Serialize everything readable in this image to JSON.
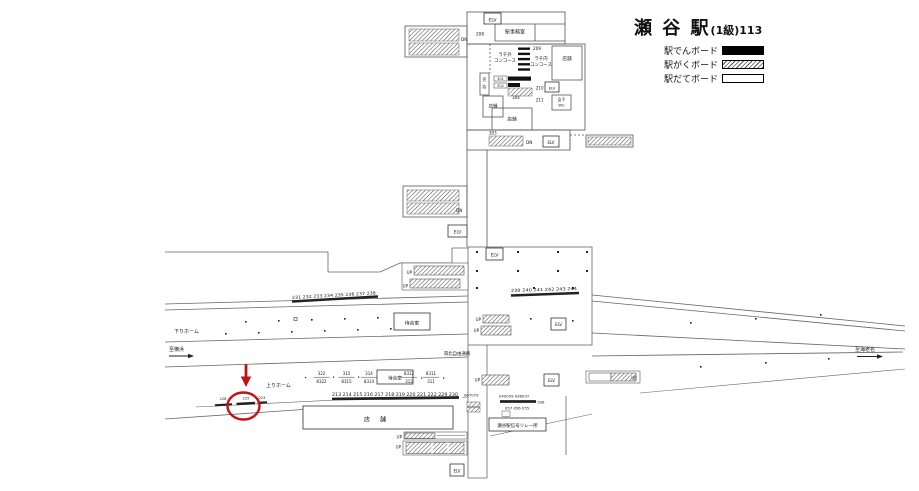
{
  "header": {
    "station_name": "瀬 谷 駅",
    "station_grade": "(1級)113"
  },
  "legend": {
    "items": [
      {
        "label": "駅でんボード",
        "style": "solid"
      },
      {
        "label": "駅がくボード",
        "style": "hatched"
      },
      {
        "label": "駅だてボード",
        "style": "outline"
      }
    ]
  },
  "labels": {
    "elv": "ELV",
    "up": "UP",
    "dn": "DN",
    "office": "駅事務室",
    "shop": "店舗",
    "shop_wide": "店 舗",
    "kiosk_1": "売",
    "kiosk_2": "店",
    "concourse_out_1": "ラチ外",
    "concourse_out_2": "コンコース",
    "concourse_in_1": "ラチ内",
    "concourse_in_2": "コンコース",
    "womens_1": "女子",
    "womens_2": "WC",
    "waiting_room": "待合室",
    "down_platform": "下りホーム",
    "up_platform": "上りホーム",
    "to_yokohama": "至横浜",
    "to_ebina": "至海老名",
    "passage": "南北自由通路",
    "relay_office": "瀬谷駅信号リレー所"
  },
  "boards": {
    "upper": {
      "n208": "208",
      "n209": "209",
      "n210": "210",
      "n211": "211",
      "n301": "301",
      "n302": "302",
      "n303": "303",
      "n304": "304"
    },
    "lower": {
      "row_231_238": "231 232 233 234 235 236 237 238",
      "row_239_244": "239 240 241 242 243 244",
      "row_213_230": "213 214 215 216 217 218 219 220 221 222 229 230",
      "n226": "226",
      "n225": "225",
      "n224": "224",
      "n067079": "067079",
      "cluster_line1": "040039 038037",
      "cluster_line2": "036",
      "cluster_line3": "057 056 055",
      "stacks": [
        {
          "top": "322",
          "bottom": "8322"
        },
        {
          "top": "315",
          "bottom": "8315"
        },
        {
          "top": "314",
          "bottom": "8314"
        },
        {
          "top": "8312",
          "bottom": "312"
        },
        {
          "top": "8311",
          "bottom": "311"
        }
      ]
    }
  },
  "annotation": {
    "circled_board": "225",
    "color": "#c41212"
  },
  "colors": {
    "line": "#555555",
    "board_black": "#111111",
    "text": "#151515",
    "highlight": "#c41212"
  }
}
